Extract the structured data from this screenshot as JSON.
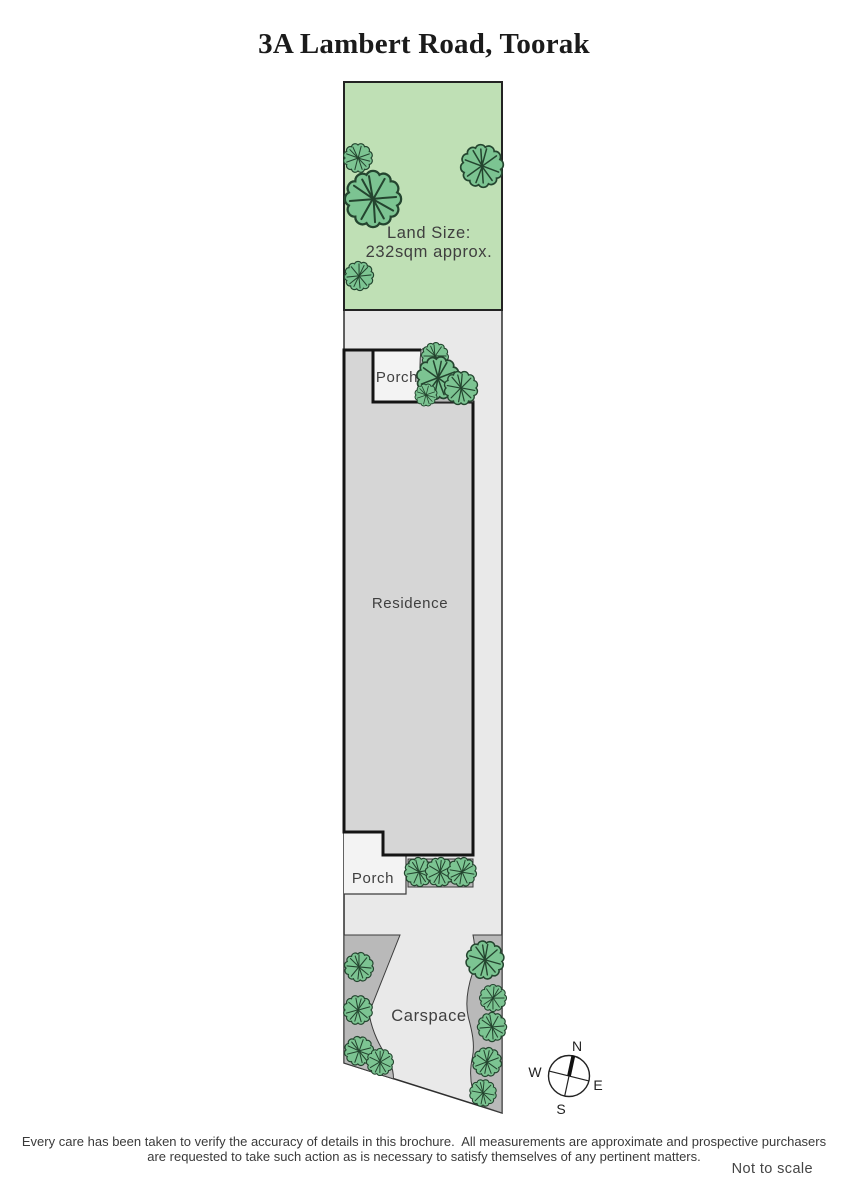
{
  "title": "3A Lambert Road, Toorak",
  "plan": {
    "land_size_line1": "Land Size:",
    "land_size_line2": "232sqm approx.",
    "porch_top_label": "Porch",
    "residence_label": "Residence",
    "porch_bottom_label": "Porch",
    "carspace_label": "Carspace"
  },
  "compass": {
    "north": "N",
    "south": "S",
    "east": "E",
    "west": "W"
  },
  "footer": {
    "disclaimer_line1": "Every care has been taken to verify the accuracy of details in this brochure.  All measurements are approximate and prospective purchasers",
    "disclaimer_line2": "are requested to take such action as is necessary to satisfy themselves of any pertinent matters.",
    "not_to_scale": "Not to scale"
  },
  "colors": {
    "grass_green": "#bfe0b5",
    "tree_green": "#7cc492",
    "tree_outline": "#24452f",
    "site_grey": "#e9e9e9",
    "residence_grey": "#d6d6d6",
    "garden_bed_grey": "#b9b9b9",
    "porch_white": "#f3f3f3",
    "outline_black": "#141414"
  }
}
